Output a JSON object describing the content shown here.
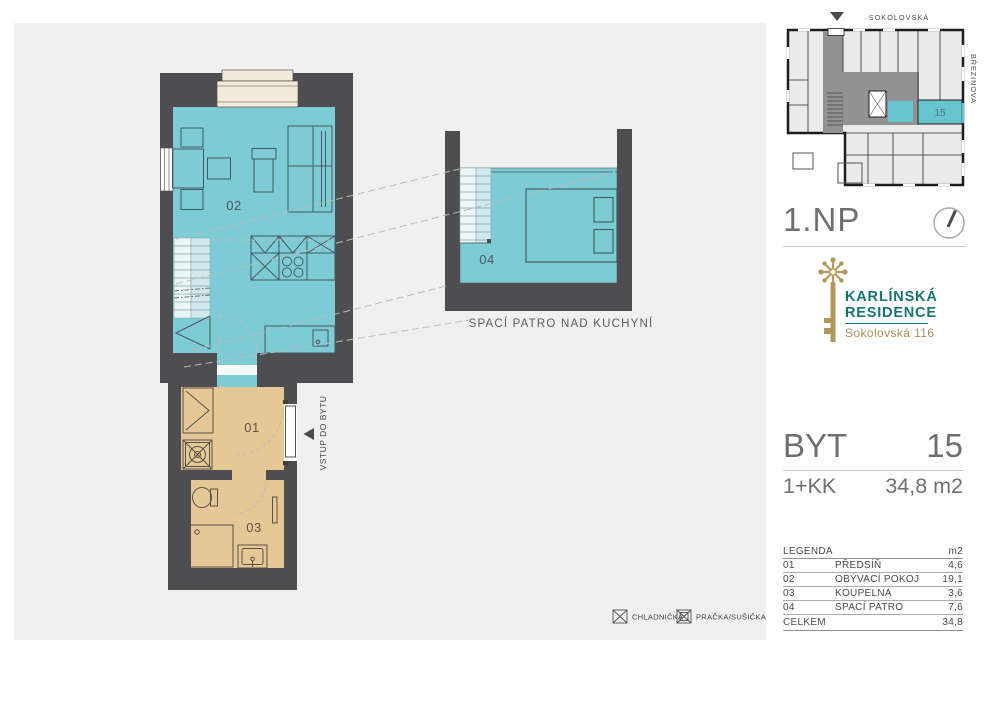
{
  "floorplan": {
    "room_labels": {
      "r01": "01",
      "r02": "02",
      "r03": "03",
      "r04": "04"
    },
    "loft_caption": "SPACÍ PATRO NAD KUCHYNÍ",
    "entry_label": "VSTUP DO BYTU"
  },
  "appliance_legend": {
    "fridge_label": "CHLADNIČKA",
    "washer_label": "PRAČKA/SUŠIČKA"
  },
  "minimap": {
    "street_top": "SOKOLOVSKÁ",
    "street_right": "BŘEZINOVA",
    "highlighted_unit": "15"
  },
  "sidebar": {
    "floor_label": "1.NP",
    "brand": {
      "name_line1": "KARLÍNSKÁ",
      "name_line2": "RESIDENCE",
      "address": "Sokolovská 116"
    },
    "unit": {
      "type_label": "BYT",
      "number": "15",
      "layout": "1+KK",
      "area": "34,8 m2"
    },
    "legend": {
      "title": "LEGENDA",
      "area_header": "m2",
      "rows": [
        {
          "num": "01",
          "name": "PŘEDSÍŇ",
          "area": "4,6"
        },
        {
          "num": "02",
          "name": "OBÝVACÍ POKOJ",
          "area": "19,1"
        },
        {
          "num": "03",
          "name": "KOUPELNA",
          "area": "3,6"
        },
        {
          "num": "04",
          "name": "SPACÍ PATRO",
          "area": "7,6"
        }
      ],
      "total_label": "CELKEM",
      "total_area": "34,8"
    }
  },
  "colors": {
    "panel_bg": "#f0f0f1",
    "wall": "#4e4e50",
    "floor_cyan": "#7dccd5",
    "floor_tan": "#e6c796",
    "window_beige": "#f3ead7",
    "brand_teal": "#17756f",
    "brand_gold": "#b3985c",
    "sidebar_text": "#6f6f71"
  }
}
